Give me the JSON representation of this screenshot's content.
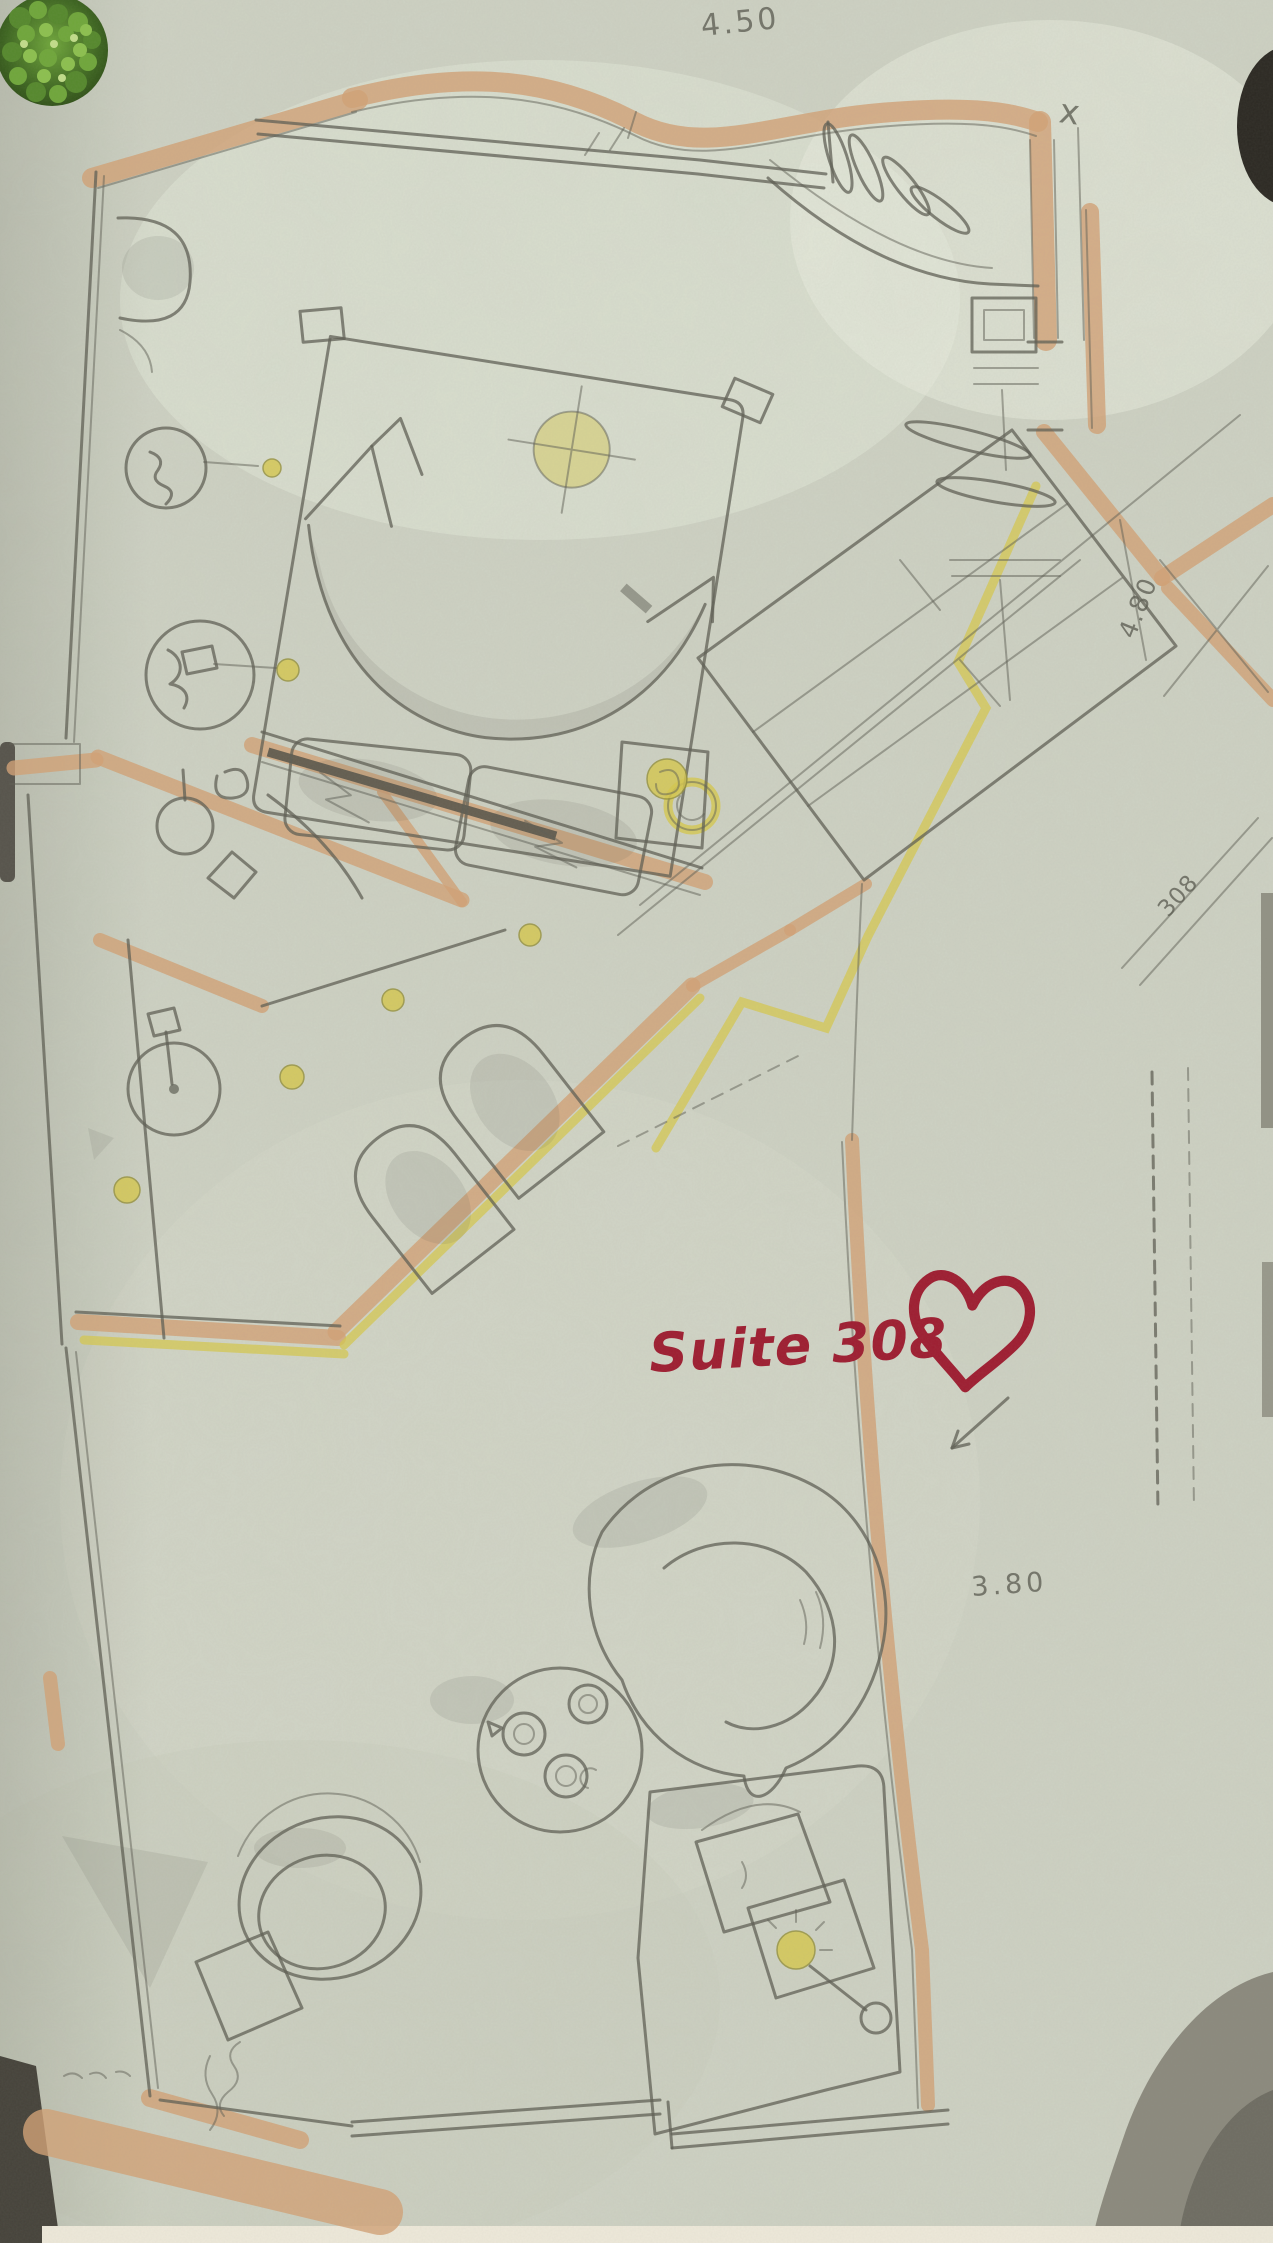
{
  "annotations": {
    "suite_label": "Suite 308",
    "dim_top": "4.50",
    "dim_right_rotated": "4.80",
    "room_number_rotated": "308",
    "dim_living": "3.80",
    "mark_top_right": "x"
  },
  "icons": {
    "heart": "red-heart-outline-icon",
    "plant": "green-plant-top-view-photo"
  },
  "colors": {
    "paper": "#cdd1c3",
    "paper_light": "#e7ebdb",
    "pencil": "#5d5e53",
    "pencil_dark": "#45463e",
    "wall_tan": "#d2a176",
    "wall_tan_dark": "#bb8458",
    "accent_yellow": "#d6c84f",
    "suite_red": "#9e1c30",
    "plant_green": "#55882c",
    "scan_dark": "#2b2822",
    "scan_gray": "#8b897d",
    "edge_cream": "#eee9da"
  }
}
